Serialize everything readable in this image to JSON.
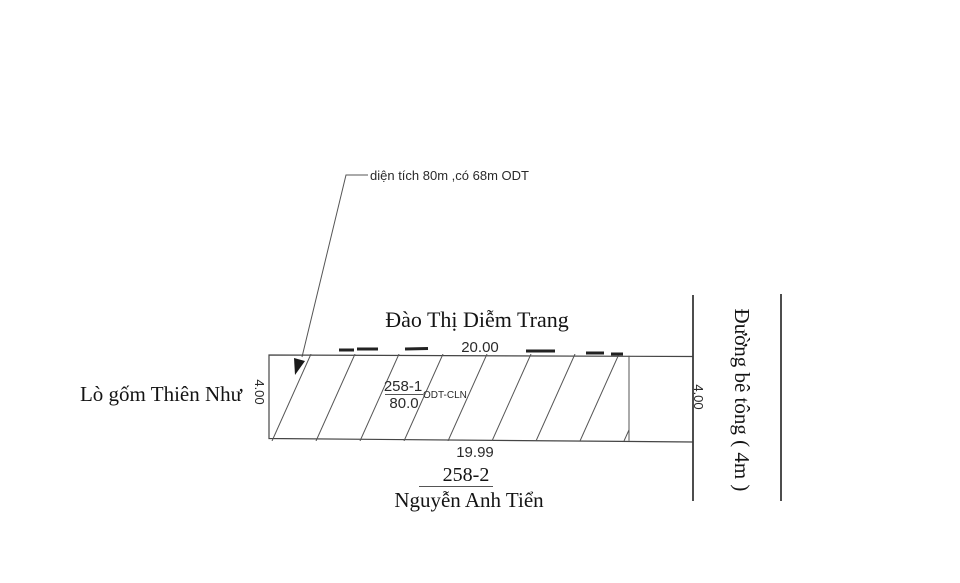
{
  "annotation": {
    "label": "diện tích 80m ,có 68m ODT"
  },
  "adjacent_top": {
    "name": "Đào Thị Diễm Trang"
  },
  "adjacent_left": {
    "name": "Lò gốm Thiên Như"
  },
  "adjacent_bottom": {
    "parcel": "258-2",
    "name": "Nguyễn Anh Tiển"
  },
  "road": {
    "name": "Đường bê tông ( 4m )"
  },
  "parcel": {
    "number": "258-1",
    "area": "80.0",
    "land_use": "ODT-CLN"
  },
  "dimensions": {
    "top": "20.00",
    "bottom": "19.99",
    "left": "4.00",
    "right": "4.00"
  },
  "colors": {
    "line": "#454545",
    "text": "#141414"
  }
}
